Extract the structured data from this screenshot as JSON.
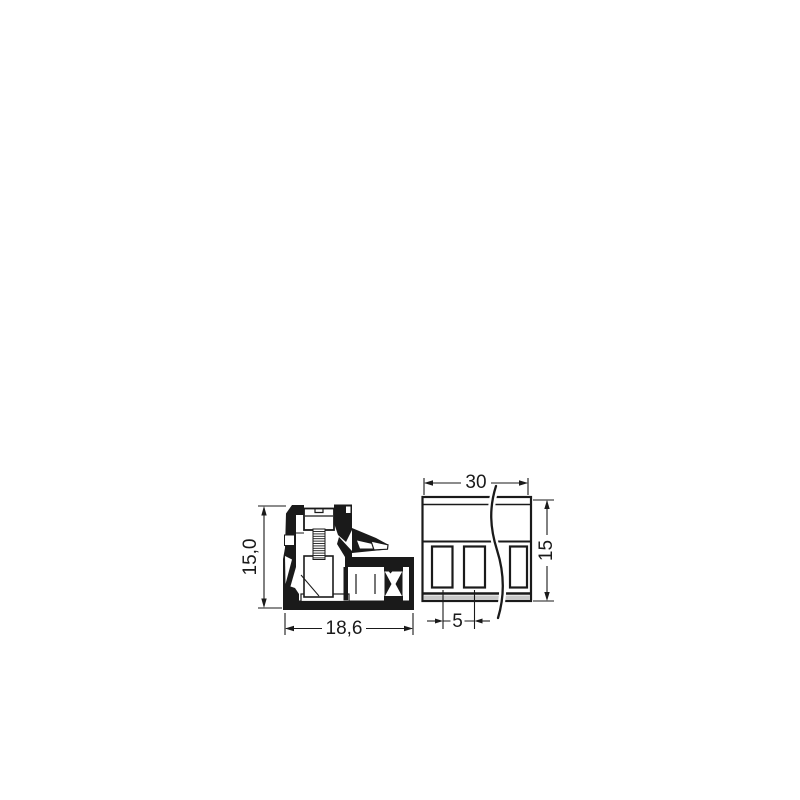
{
  "drawing": {
    "colors": {
      "line": "#1a1a1a",
      "accent": "#cc3333",
      "shade": "#c9c9c9",
      "background": "#ffffff"
    },
    "side_view": {
      "dims": {
        "height": "15,0",
        "width": "18,6"
      }
    },
    "front_view": {
      "dims": {
        "width": "30",
        "height": "15",
        "pitch": "5"
      },
      "terminal_openings_visible": 3
    }
  }
}
